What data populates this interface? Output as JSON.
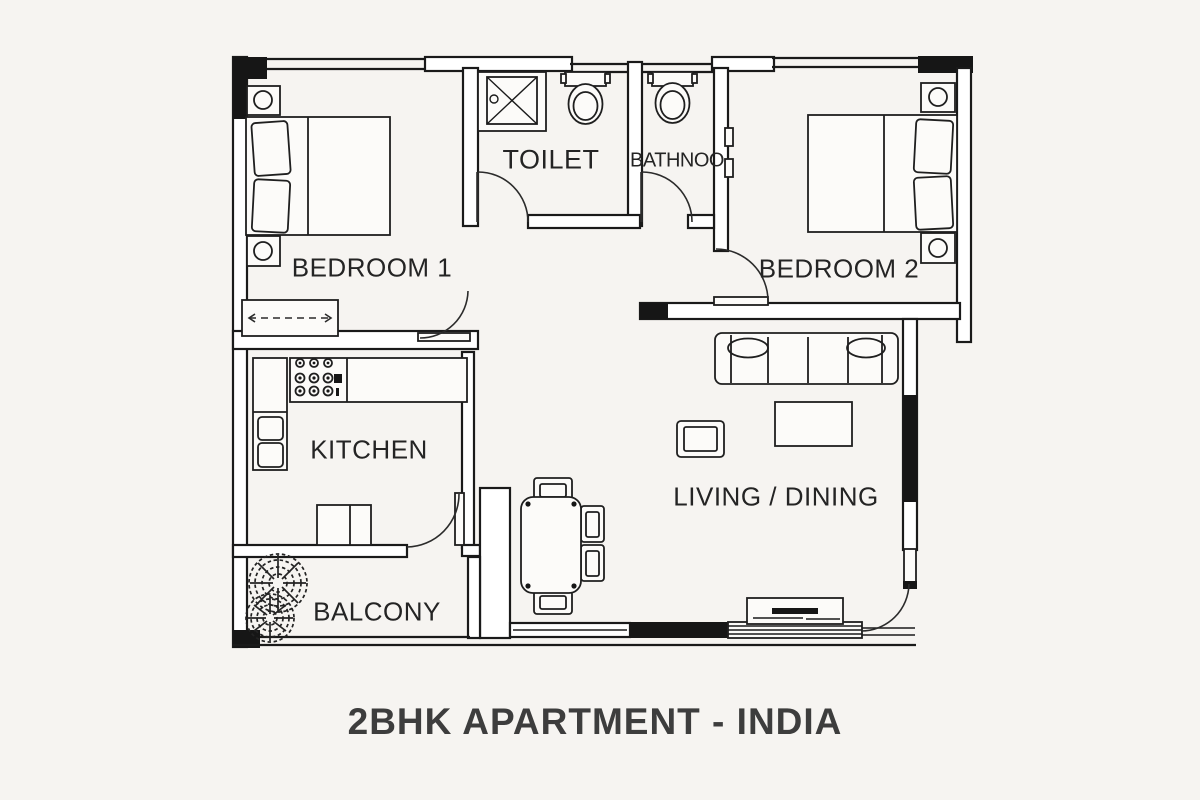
{
  "title": "2BHK APARTMENT - INDIA",
  "labels": {
    "bedroom1": "BEDROOM 1",
    "toilet": "TOILET",
    "bathroom": "BATHNOO",
    "bedroom2": "BEDROOM 2",
    "kitchen": "KITCHEN",
    "living_dining": "LIVING / DINING",
    "balcony": "BALCONY"
  },
  "colors": {
    "background": "#f6f4f1",
    "line": "#1a1a1a",
    "wall_fill": "#ffffff",
    "wall_solid": "#161616",
    "label_text": "#242424",
    "title_text": "#3d3d3d"
  },
  "icons": [
    "bed-icon",
    "pillow-icon",
    "nightstand-icon",
    "wardrobe-icon",
    "wc-icon",
    "shower-tray-icon",
    "stove-icon",
    "sink-icon",
    "kitchen-counter-icon",
    "sofa-icon",
    "armchair-icon",
    "coffee-table-icon",
    "tv-unit-icon",
    "dining-table-icon",
    "chair-icon",
    "plant-icon",
    "door-arc-icon",
    "window-icon",
    "sliding-door-icon"
  ]
}
